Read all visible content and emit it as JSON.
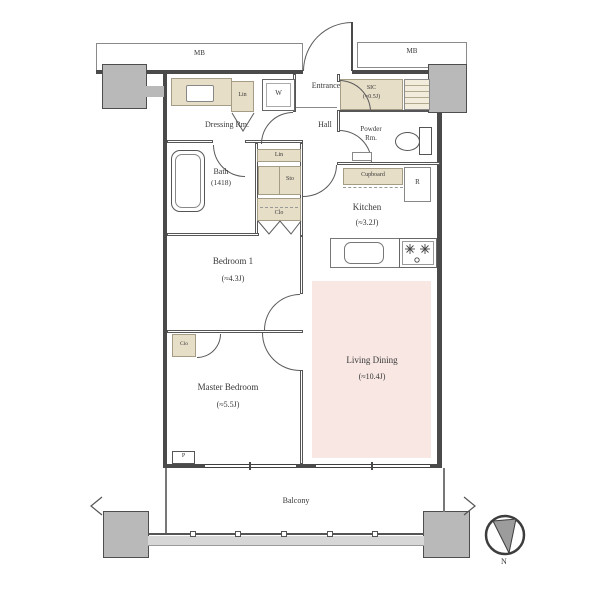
{
  "colors": {
    "wall": "#4a4a4a",
    "pillar": "#b9b9b9",
    "tan": "#e7dec8",
    "living": "#f8e7e3",
    "rail": "#d7d7d7"
  },
  "plan": {
    "rooms": {
      "dressing": {
        "label": "Dressing Rm."
      },
      "bath": {
        "label": "Bath",
        "size": "(1418)"
      },
      "entrance": {
        "label": "Entrance"
      },
      "hall": {
        "label": "Hall"
      },
      "powder": {
        "label": "Powder",
        "label2": "Rm."
      },
      "sic": {
        "label": "SIC",
        "size": "(≈0.5J)"
      },
      "kitchen": {
        "label": "Kitchen",
        "size": "(≈3.2J)"
      },
      "bedroom1": {
        "label": "Bedroom 1",
        "size": "(≈4.3J)"
      },
      "master": {
        "label": "Master Bedroom",
        "size": "(≈5.5J)"
      },
      "living": {
        "label": "Living Dining",
        "size": "(≈10.4J)"
      },
      "balcony": {
        "label": "Balcony"
      }
    },
    "fixtures": {
      "meter_box_left": "MB",
      "meter_box_right": "MB",
      "linen_dressing": "Lin",
      "washer": "W",
      "linen_hall": "Lin",
      "storage": "Sto",
      "closet_hall": "Clo",
      "closet_master": "Clo",
      "cupboard": "Cupboard",
      "refrigerator": "R",
      "pipe_space": "P"
    },
    "compass": {
      "north": "N"
    }
  }
}
